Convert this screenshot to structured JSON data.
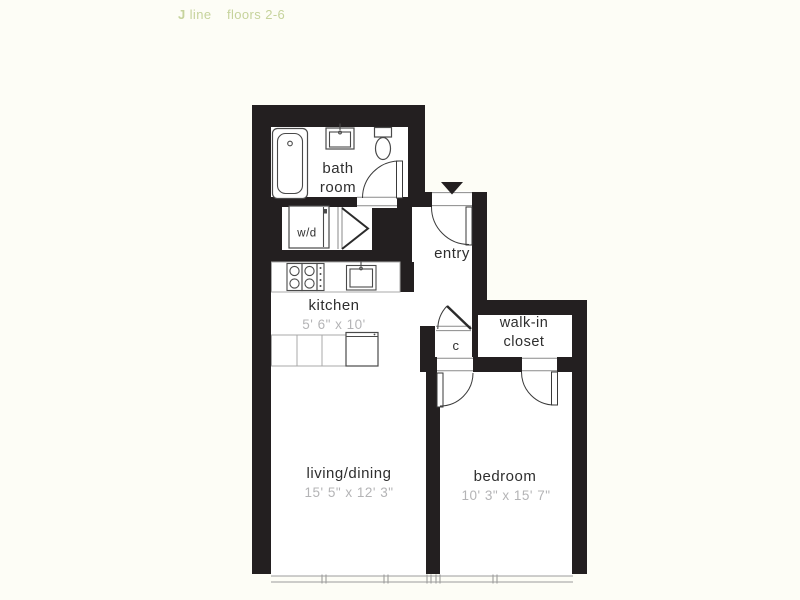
{
  "header": {
    "unit_bold": "J",
    "unit_rest": "line",
    "floors": "floors 2-6",
    "accent_color": "#c6d39c"
  },
  "floorplan": {
    "colors": {
      "background": "#fdfdf6",
      "wall": "#231f20",
      "label_text": "#2e2e2e",
      "dimension_text": "#b4b4b6",
      "fixture_outline": "#4a4a4a",
      "counter_outline": "#a9a9a9"
    },
    "rooms": {
      "bathroom": {
        "label_line1": "bath",
        "label_line2": "room"
      },
      "washer_dryer": {
        "label": "w/d"
      },
      "entry": {
        "label": "entry"
      },
      "kitchen": {
        "label": "kitchen",
        "dims": "5' 6\" x 10'"
      },
      "closet": {
        "label": "c"
      },
      "walk_in_closet": {
        "label_line1": "walk-in",
        "label_line2": "closet"
      },
      "living_dining": {
        "label": "living/dining",
        "dims": "15' 5\" x 12' 3\""
      },
      "bedroom": {
        "label": "bedroom",
        "dims": "10' 3\" x 15' 7\""
      }
    }
  }
}
